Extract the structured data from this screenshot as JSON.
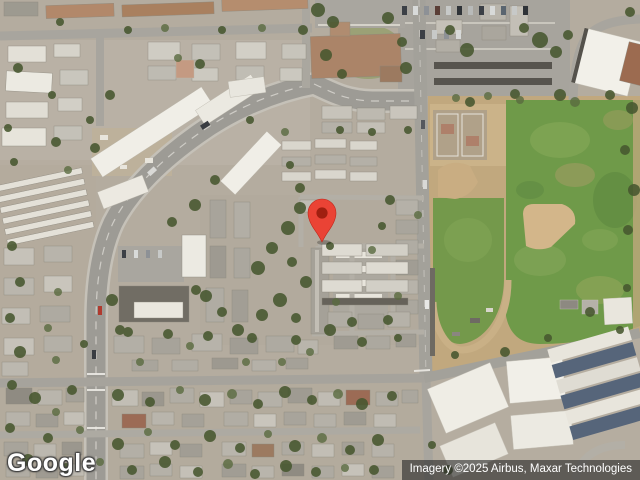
{
  "map": {
    "view": "satellite",
    "provider_logo": "Google",
    "attribution": "Imagery ©2025 Airbus, Maxar Technologies",
    "marker": {
      "type": "map-pin",
      "color": "#EA4335",
      "dot_color": "#A01F10",
      "tip_x": 322,
      "tip_y": 245
    },
    "colors": {
      "road": "#a3a19a",
      "arterial_road": "#9d9b95",
      "grass_field": "#6f9a49",
      "dirt": "#c1a87e",
      "building_white": "#efede6",
      "building_tan": "#ab8468",
      "tree_green": "#47572f",
      "attribution_bg": "rgba(40,40,40,0.62)"
    }
  }
}
